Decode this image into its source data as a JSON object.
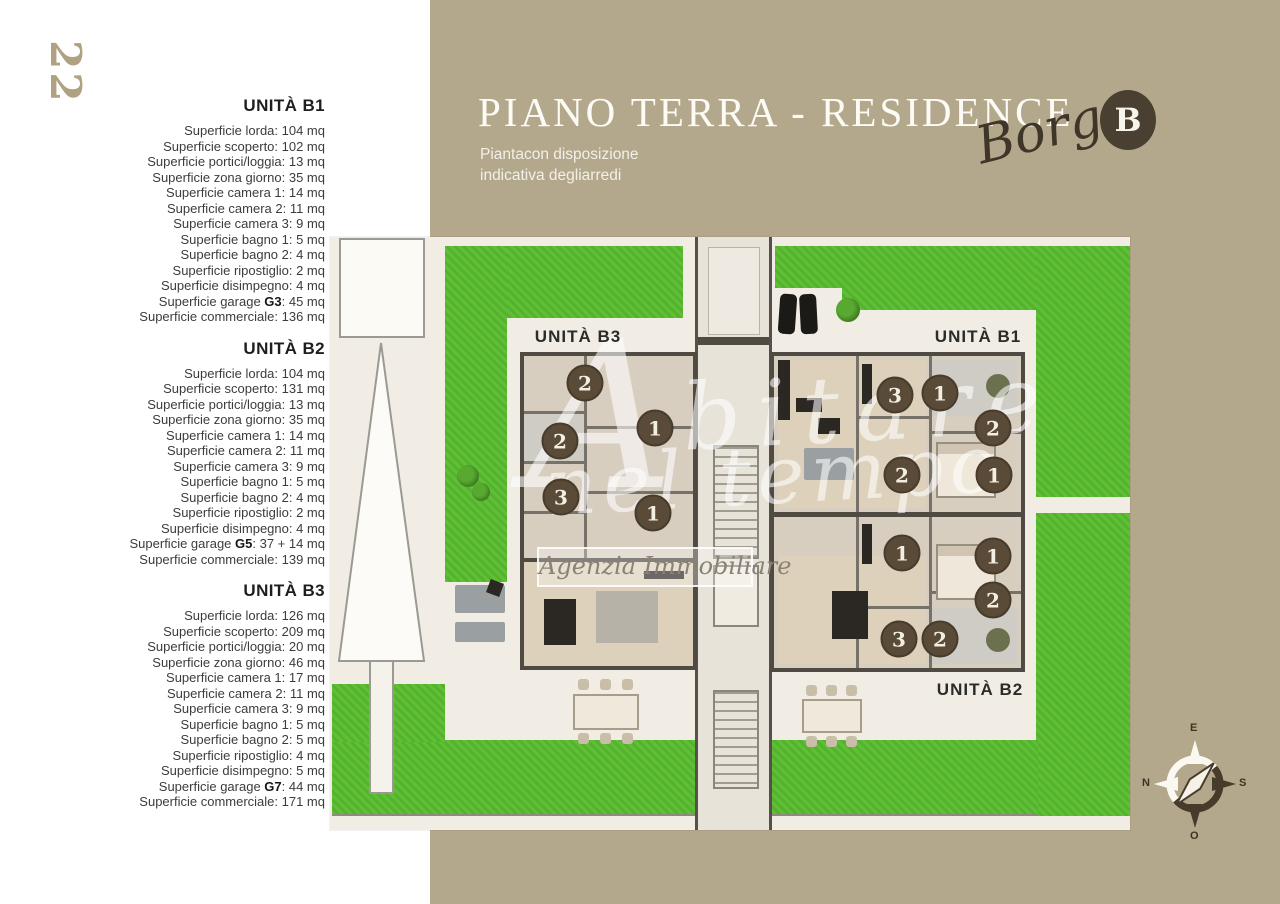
{
  "page": {
    "number": "22"
  },
  "colors": {
    "panel": "#b4a88c",
    "grass": "#56ba2c",
    "wall": "#4f4b43",
    "room": "#d8cec0",
    "room-alt": "#ddd1bb",
    "badge-bg": "#594b38",
    "accent-dark": "#4a4031",
    "plan-bg": "#f1ede5",
    "title": "#fcfbf6",
    "page-number": "#b0a182",
    "spec-text": "#3c3c3a",
    "spec-heading": "#1e1e1c"
  },
  "header": {
    "title": "PIANO TERRA - RESIDENCE",
    "subtitle_line1": "Piantacon disposizione",
    "subtitle_line2": "indicativa degliarredi",
    "brand_script": "Borgo",
    "brand_badge_letter": "B"
  },
  "units": [
    {
      "name": "UNITÀ B1",
      "lines": [
        [
          "Superficie lorda: 104 mq"
        ],
        [
          "Superficie scoperto: 102 mq"
        ],
        [
          "Superficie portici/loggia: 13 mq"
        ],
        [
          "Superficie zona giorno: 35 mq"
        ],
        [
          "Superficie camera 1: 14 mq"
        ],
        [
          "Superficie camera 2: 11 mq"
        ],
        [
          "Superficie camera 3: 9 mq"
        ],
        [
          "Superficie bagno 1: 5 mq"
        ],
        [
          "Superficie bagno 2: 4 mq"
        ],
        [
          "Superficie ripostiglio: 2 mq"
        ],
        [
          "Superficie disimpegno: 4 mq"
        ],
        [
          "Superficie garage ",
          "G3",
          ": 45 mq"
        ],
        [
          "Superficie commerciale: 136 mq"
        ]
      ]
    },
    {
      "name": "UNITÀ B2",
      "lines": [
        [
          "Superficie lorda: 104 mq"
        ],
        [
          "Superficie scoperto: 131 mq"
        ],
        [
          "Superficie portici/loggia: 13 mq"
        ],
        [
          "Superficie zona giorno: 35 mq"
        ],
        [
          "Superficie camera 1: 14 mq"
        ],
        [
          "Superficie camera 2: 11 mq"
        ],
        [
          "Superficie camera 3: 9 mq"
        ],
        [
          "Superficie bagno 1: 5 mq"
        ],
        [
          "Superficie bagno 2: 4 mq"
        ],
        [
          "Superficie ripostiglio: 2 mq"
        ],
        [
          "Superficie disimpegno: 4 mq"
        ],
        [
          "Superficie garage ",
          "G5",
          ": 37 + 14 mq"
        ],
        [
          "Superficie commerciale: 139 mq"
        ]
      ]
    },
    {
      "name": "UNITÀ B3",
      "lines": [
        [
          "Superficie lorda: 126 mq"
        ],
        [
          "Superficie scoperto: 209 mq"
        ],
        [
          "Superficie portici/loggia: 20 mq"
        ],
        [
          "Superficie zona giorno: 46 mq"
        ],
        [
          "Superficie camera 1: 17 mq"
        ],
        [
          "Superficie camera 2: 11 mq"
        ],
        [
          "Superficie camera 3: 9 mq"
        ],
        [
          "Superficie bagno 1: 5 mq"
        ],
        [
          "Superficie bagno 2: 5 mq"
        ],
        [
          "Superficie ripostiglio: 4 mq"
        ],
        [
          "Superficie disimpegno: 5 mq"
        ],
        [
          "Superficie garage ",
          "G7",
          ": 44 mq"
        ],
        [
          "Superficie commerciale: 171 mq"
        ]
      ]
    }
  ],
  "plan": {
    "unit_labels": [
      {
        "text": "UNITÀ B3",
        "x": 578,
        "y": 337
      },
      {
        "text": "UNITÀ B1",
        "x": 978,
        "y": 337
      },
      {
        "text": "UNITÀ B2",
        "x": 980,
        "y": 690
      }
    ],
    "badges": [
      {
        "n": "2",
        "x": 585,
        "y": 383
      },
      {
        "n": "1",
        "x": 655,
        "y": 428
      },
      {
        "n": "2",
        "x": 560,
        "y": 441
      },
      {
        "n": "3",
        "x": 561,
        "y": 497
      },
      {
        "n": "1",
        "x": 653,
        "y": 513
      },
      {
        "n": "3",
        "x": 895,
        "y": 395
      },
      {
        "n": "1",
        "x": 940,
        "y": 393
      },
      {
        "n": "2",
        "x": 993,
        "y": 428
      },
      {
        "n": "2",
        "x": 902,
        "y": 475
      },
      {
        "n": "1",
        "x": 994,
        "y": 475
      },
      {
        "n": "1",
        "x": 902,
        "y": 553
      },
      {
        "n": "1",
        "x": 993,
        "y": 556
      },
      {
        "n": "2",
        "x": 993,
        "y": 600
      },
      {
        "n": "3",
        "x": 899,
        "y": 639
      },
      {
        "n": "2",
        "x": 940,
        "y": 639
      }
    ]
  },
  "watermark": {
    "initial": "A",
    "rest": "bitare",
    "line2": "nel tempo",
    "caption": "Agenzia Immobiliare"
  },
  "compass": {
    "top": "E",
    "right": "S",
    "bottom": "O",
    "left": "N"
  }
}
